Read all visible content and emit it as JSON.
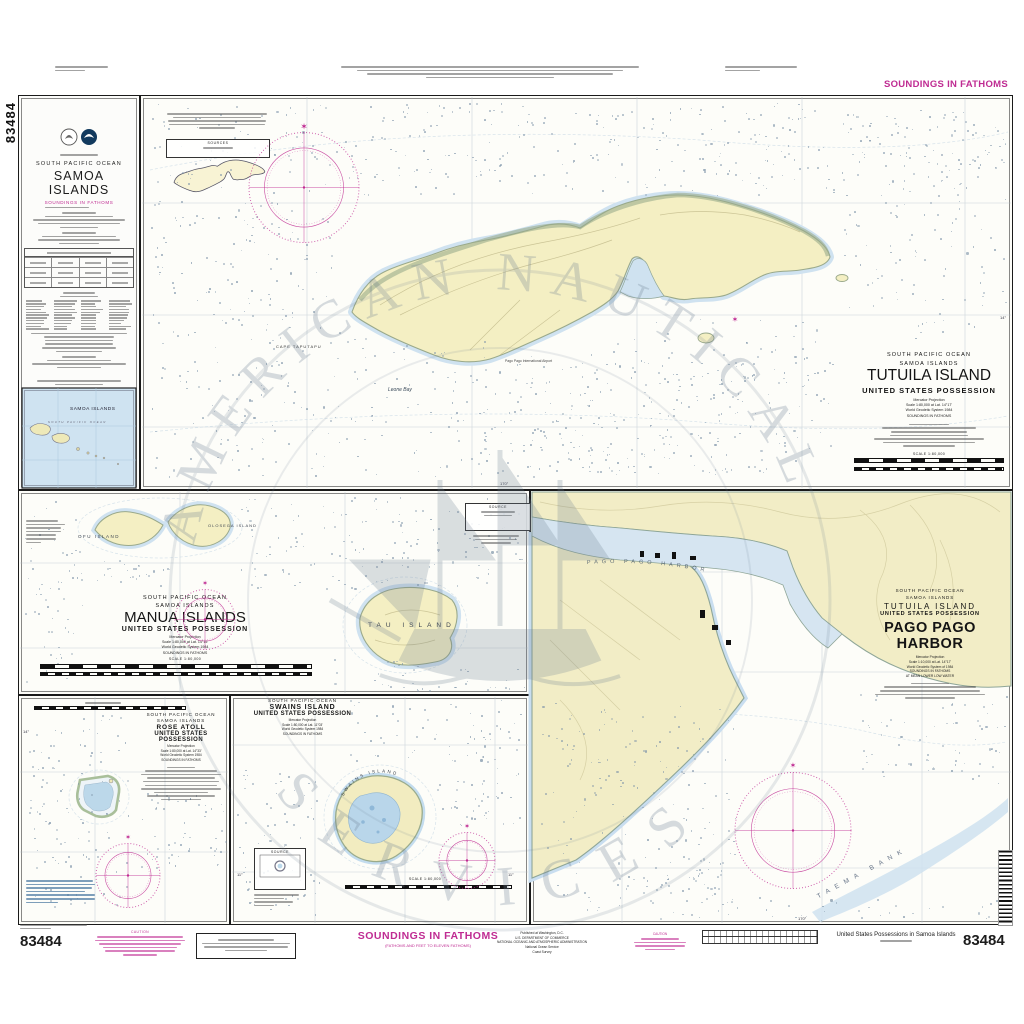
{
  "chart": {
    "number": "83484",
    "soundings": "SOUNDINGS IN FATHOMS",
    "soundings_sub": "(FATHOMS AND FEET TO ELEVEN FATHOMS)",
    "bottom_title": "United States Possessions in Samoa Islands",
    "caution_label": "CAUTION",
    "agency": [
      "Published at Washington, D.C.",
      "U.S. DEPARTMENT OF COMMERCE",
      "NATIONAL OCEANIC AND ATMOSPHERIC ADMINISTRATION",
      "National Ocean Service",
      "Coast Survey"
    ]
  },
  "icons": {
    "north_star": "✶"
  },
  "watermark": {
    "arc_top": "AMERICAN NAUTICAL",
    "arc_bottom": "SERVICES"
  },
  "samoa": {
    "ocean": "SOUTH PACIFIC OCEAN",
    "title": "SAMOA ISLANDS",
    "soundings": "SOUNDINGS IN FATHOMS",
    "inset_title": "SAMOA ISLANDS",
    "inset_ocean": "SOUTH PACIFIC OCEAN"
  },
  "tutuila": {
    "ocean": "SOUTH PACIFIC OCEAN",
    "region": "SAMOA ISLANDS",
    "title": "TUTUILA ISLAND",
    "possession": "UNITED STATES POSSESSION",
    "proj": "Mercator Projection",
    "scale": "Scale 1:80,000 at Lat. 14°17'",
    "datum": "World Geodetic System 1984",
    "soundings": "SOUNDINGS IN FATHOMS",
    "scale_label": "SCALE 1:80,000",
    "sources_label": "SOURCES",
    "cape": "CAPE TAPUTAPU",
    "bay": "Leone Bay",
    "airport": "Pago Pago International Airport"
  },
  "manua": {
    "ocean": "SOUTH PACIFIC OCEAN",
    "region": "SAMOA ISLANDS",
    "title": "MANUA ISLANDS",
    "possession": "UNITED STATES POSSESSION",
    "proj": "Mercator Projection",
    "scale": "Scale 1:80,000 at Lat. 14°15'",
    "datum": "World Geodetic System 1984",
    "soundings": "SOUNDINGS IN FATHOMS",
    "scale_label": "SCALE 1:80,000",
    "source_label": "SOURCE",
    "ofu": "OFU ISLAND",
    "olosega": "OLOSEGA ISLAND",
    "tau": "TAU ISLAND"
  },
  "rose": {
    "ocean": "SOUTH PACIFIC OCEAN",
    "region": "SAMOA ISLANDS",
    "title": "ROSE ATOLL",
    "possession": "UNITED STATES POSSESSION",
    "proj": "Mercator Projection",
    "scale": "Scale 1:80,000 at Lat. 14°33'",
    "datum": "World Geodetic System 1984",
    "soundings": "SOUNDINGS IN FATHOMS"
  },
  "swains": {
    "ocean": "SOUTH PACIFIC OCEAN",
    "title": "SWAINS ISLAND",
    "possession": "UNITED STATES POSSESSION",
    "proj": "Mercator Projection",
    "scale": "Scale 1:80,000 at Lat. 11°03'",
    "datum": "World Geodetic System 1984",
    "soundings": "SOUNDINGS IN FATHOMS",
    "island_label": "SWAINS ISLAND",
    "source_label": "SOURCE",
    "scale_label": "SCALE 1:80,000"
  },
  "pago": {
    "ocean": "SOUTH PACIFIC OCEAN",
    "region": "SAMOA ISLANDS",
    "island": "TUTUILA ISLAND",
    "possession": "UNITED STATES POSSESSION",
    "title": "PAGO PAGO HARBOR",
    "proj": "Mercator Projection",
    "scale": "Scale 1:10,000 at Lat. 14°17'",
    "datum": "World Geodetic System of 1984",
    "soundings": "SOUNDINGS IN FATHOMS",
    "mlw": "AT MEAN LOWER LOW WATER",
    "harbor_label": "PAGO PAGO HARBOR",
    "bank_label": "TAEMA BANK"
  },
  "graticule": {
    "lat14": "14°",
    "lon170": "170°",
    "lat11": "11°"
  }
}
